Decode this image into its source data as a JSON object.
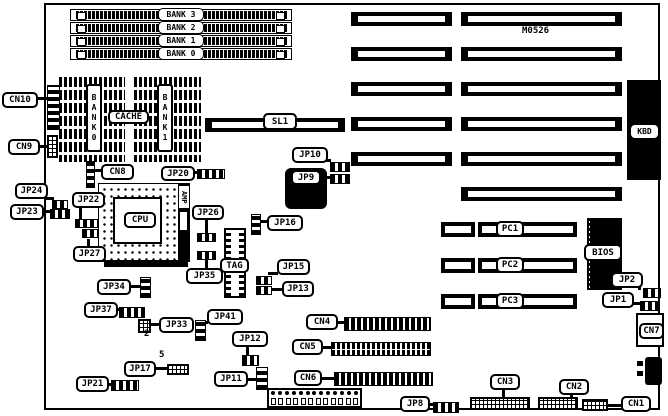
{
  "board": {
    "model": "M0526"
  },
  "simm": {
    "banks": [
      "BANK 3",
      "BANK 2",
      "BANK 1",
      "BANK 0"
    ]
  },
  "cache": {
    "left_bank": "BANK0",
    "center": "CACHE",
    "right_bank": "BANK1"
  },
  "cpu": {
    "label": "CPU",
    "amp_chip": "AMP",
    "tag_chip": "TAG"
  },
  "slots": {
    "sl1": "SL1",
    "pci": [
      {
        "label": "PC1"
      },
      {
        "label": "PC2"
      },
      {
        "label": "PC3"
      }
    ]
  },
  "chips": {
    "bios": "BIOS",
    "keyboard": "KBD"
  },
  "connectors": {
    "cn1": "CN1",
    "cn2": "CN2",
    "cn3": "CN3",
    "cn4": "CN4",
    "cn5": "CN5",
    "cn6": "CN6",
    "cn7": "CN7",
    "cn8": "CN8",
    "cn9": "CN9",
    "cn10": "CN10"
  },
  "jumpers": {
    "jp1": "JP1",
    "jp2": "JP2",
    "jp8": "JP8",
    "jp9": "JP9",
    "jp10": "JP10",
    "jp11": "JP11",
    "jp12": "JP12",
    "jp13": "JP13",
    "jp15": "JP15",
    "jp16": "JP16",
    "jp17": "JP17",
    "jp20": "JP20",
    "jp21": "JP21",
    "jp22": "JP22",
    "jp23": "JP23",
    "jp24": "JP24",
    "jp26": "JP26",
    "jp27": "JP27",
    "jp33": "JP33",
    "jp34": "JP34",
    "jp35": "JP35",
    "jp37": "JP37",
    "jp41": "JP41"
  },
  "annotations": {
    "jp33_pin": "2",
    "jp17_pin": "5"
  }
}
